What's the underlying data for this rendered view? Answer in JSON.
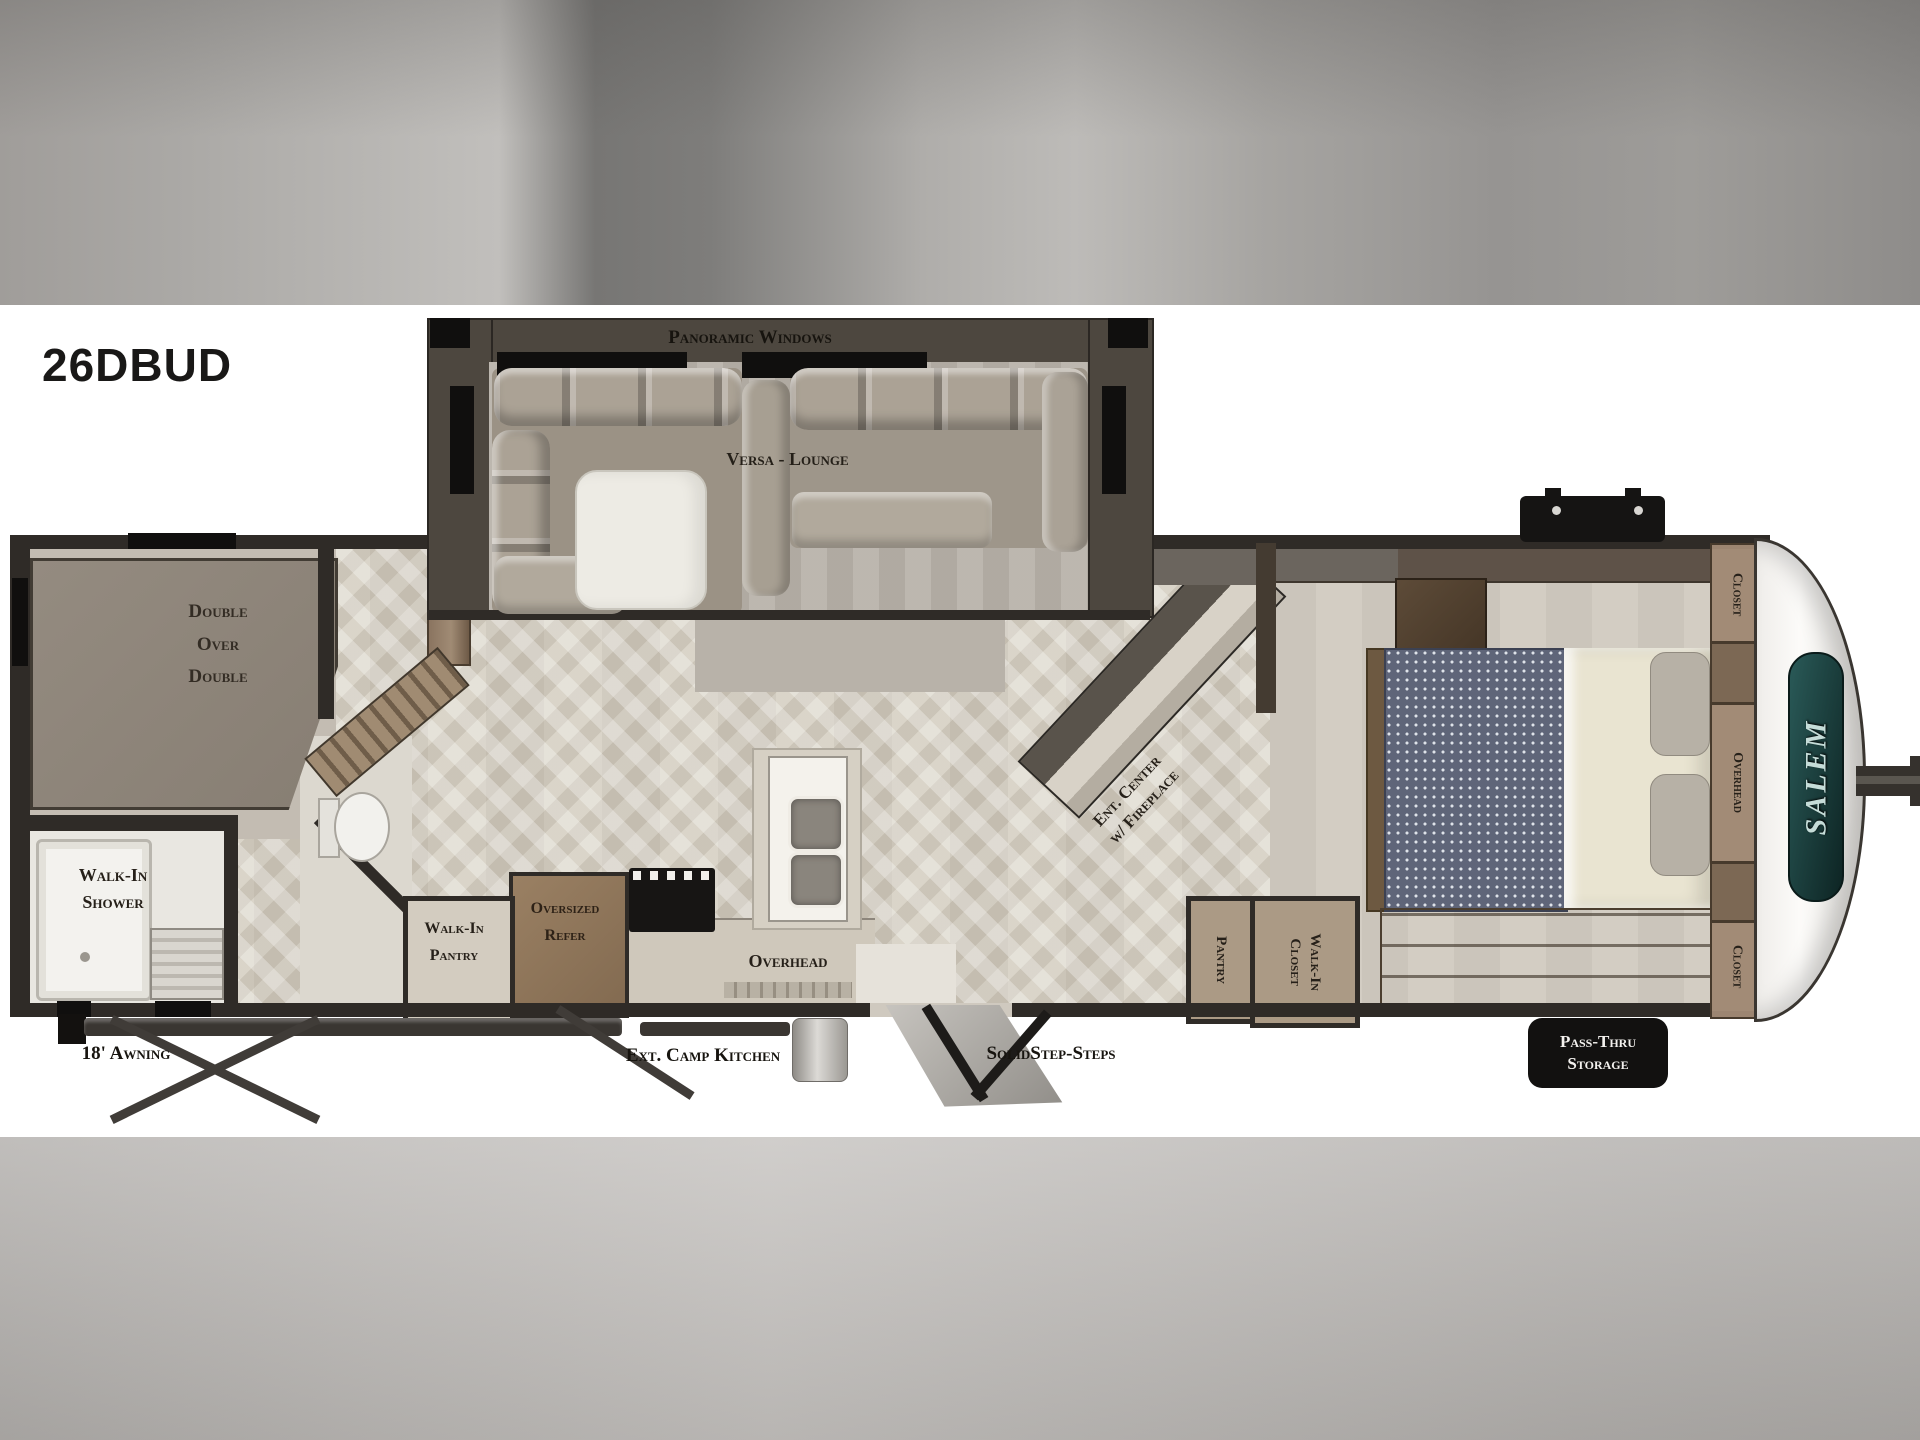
{
  "model": "26DBUD",
  "brand": "SALEM",
  "colors": {
    "wall": "#2f2b27",
    "floor": "#d8d2c6",
    "badge_black": "#121110",
    "logo_teal": "#1e4a47"
  },
  "lounge_slide": {
    "windows_label": "Panoramic Windows",
    "lounge_label": "Versa - Lounge"
  },
  "bunk_room": {
    "line1": "Double",
    "line2": "Over",
    "line3": "Double"
  },
  "bathroom": {
    "shower_line1": "Walk-In",
    "shower_line2": "Shower"
  },
  "kitchen": {
    "pantry_line1": "Walk-In",
    "pantry_line2": "Pantry",
    "refer_line1": "Oversized",
    "refer_line2": "Refer",
    "overhead_label": "Overhead"
  },
  "living_area": {
    "ent_center_line1": "Ent. Center",
    "ent_center_line2": "w/ Fireplace"
  },
  "hallway": {
    "pantry_label": "Pantry",
    "closet_line1": "Walk-In",
    "closet_line2": "Closet"
  },
  "bedroom": {
    "closet_top_label": "Closet",
    "overhead_label": "Overhead",
    "closet_bottom_label": "Closet"
  },
  "exterior": {
    "awning_label": "18' Awning",
    "camp_kitchen_label": "Ext. Camp Kitchen",
    "steps_label": "SolidStep-Steps",
    "pass_thru_line1": "Pass-Thru",
    "pass_thru_line2": "Storage"
  }
}
